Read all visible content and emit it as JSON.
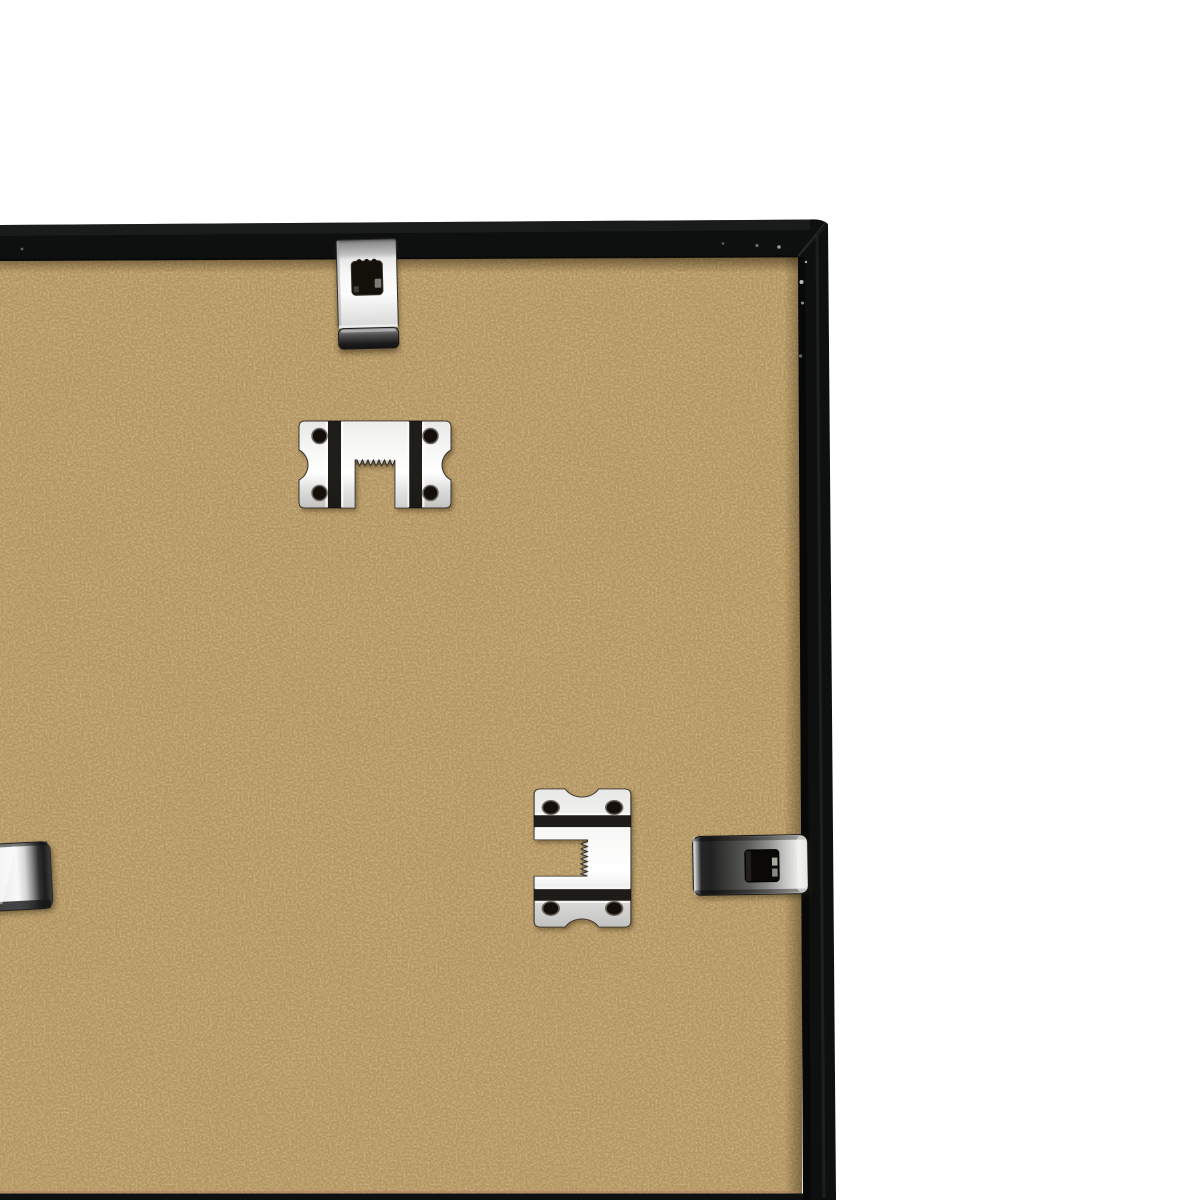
{
  "image": {
    "type": "product-photo",
    "description": "Close-up of the back of a black picture frame, top-right corner: tan MDF backing board held by nickel spring clips over the frame rails, with two sawtooth hangers screw-plates on the board, on a plain white background",
    "width_px": 1200,
    "height_px": 1200
  },
  "background": {
    "color": "#ffffff"
  },
  "frame": {
    "name": "black picture frame rear rails (top rail, right rail, bottom edge strip)",
    "finish": "matte black",
    "color": "#0e100f",
    "highlight_color": "#262a28",
    "visible_edges": [
      "top rail",
      "right rail",
      "bottom edge strip"
    ]
  },
  "backing_board": {
    "material": "MDF hardboard",
    "color": "#b4955f",
    "speckle_light": "#d9bf8f",
    "speckle_dark": "#8f7347",
    "seam_line_color": "#af7a64"
  },
  "hardware": {
    "finish": "nickel-plated steel",
    "metal_bright": "#f6f6f4",
    "metal_mid": "#9a9a98",
    "metal_dark": "#1f1f1d",
    "items": [
      {
        "name": "spring clip on top rail",
        "type": "frame-spring-clip",
        "position": "top center-left, hooked over top rail onto board",
        "holes": 1
      },
      {
        "name": "upper sawtooth hanger plate",
        "type": "sawtooth-hanger",
        "orientation": "horizontal, notch opening downward",
        "holes": 4
      },
      {
        "name": "lower sawtooth hanger plate",
        "type": "sawtooth-hanger",
        "orientation": "vertical, notch opening left",
        "holes": 4
      },
      {
        "name": "spring clip on right rail",
        "type": "frame-spring-clip",
        "position": "right side, hooked over right rail onto board",
        "holes": 1
      },
      {
        "name": "partial spring clip at left edge",
        "type": "frame-spring-clip",
        "position": "left image edge, mostly cropped out of view",
        "holes": 0
      }
    ]
  }
}
